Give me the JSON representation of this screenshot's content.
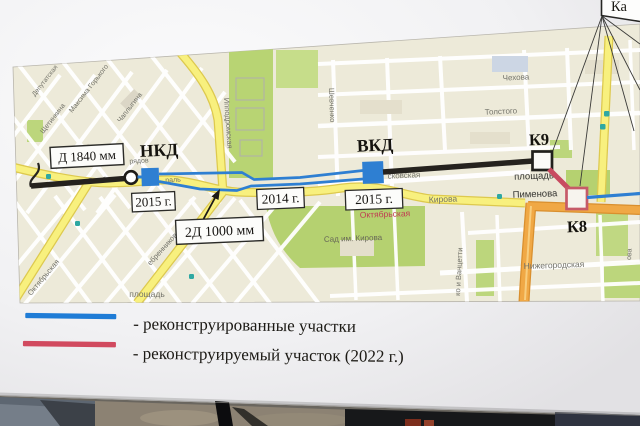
{
  "poster": {
    "description": "Схема реконструкции коллектора на карте города"
  },
  "annotations": {
    "collector_label_1": "Д 1840 мм",
    "chamber_nkd": "НКД",
    "year_2015_left": "2015 г.",
    "collector_label_2": "2Д 1000 мм",
    "year_2014": "2014 г.",
    "chamber_vkd": "ВКД",
    "year_2015_right": "2015 г.",
    "chamber_k9": "К9",
    "chamber_k8": "К8",
    "callout_partial": "Ка"
  },
  "legend": {
    "items": [
      {
        "label": "- реконструированные участки",
        "color": "#1f7cd6"
      },
      {
        "label": "- реконструируемый участок (2022 г.)",
        "color": "#d14a5f"
      }
    ]
  },
  "map": {
    "streets": {
      "deputatskaya": "Депутатская",
      "schetinkina": "Щетинкина",
      "maksima_gorkogo": "Максима Горького",
      "chaplygina": "Чаплыгина",
      "ryadov": "рядов",
      "magistral_fragment_1": "Октяб",
      "magistral_fragment_2": "раль",
      "ippodromskaya": "Ипподромская",
      "shevchenko": "Шевченко",
      "chekhova": "Чехова",
      "tolstogo": "Толстого",
      "moskovskaya_fragment": "сковская",
      "kirova": "Кирова",
      "metro_oktyabrskaya": "Октябрьская",
      "ploshchad_pimenova_line1": "площадь",
      "ploshchad_pimenova_line2": "Пименова",
      "sad_im_kirova": "Сад им. Кирова",
      "nizhegorodskaya": "Нижегородская",
      "sakko_i_vantsetti_fragment": "ко и Ванцетти",
      "serebrennikovskaya_fragment": "ебренниковская",
      "oktyabrskaya_street": "Октябрьская",
      "ploshchad_bottom": "площадь",
      "ova_fragment": "ова"
    }
  },
  "colors": {
    "reconstructed_blue": "#2e7fd2",
    "under_reconstruction_red": "#c84b60",
    "collector_black": "#25221e",
    "road_yellow": "#f8f07e",
    "road_orange": "#f0a845",
    "park_green": "#b8d473",
    "map_bg": "#edead9"
  }
}
